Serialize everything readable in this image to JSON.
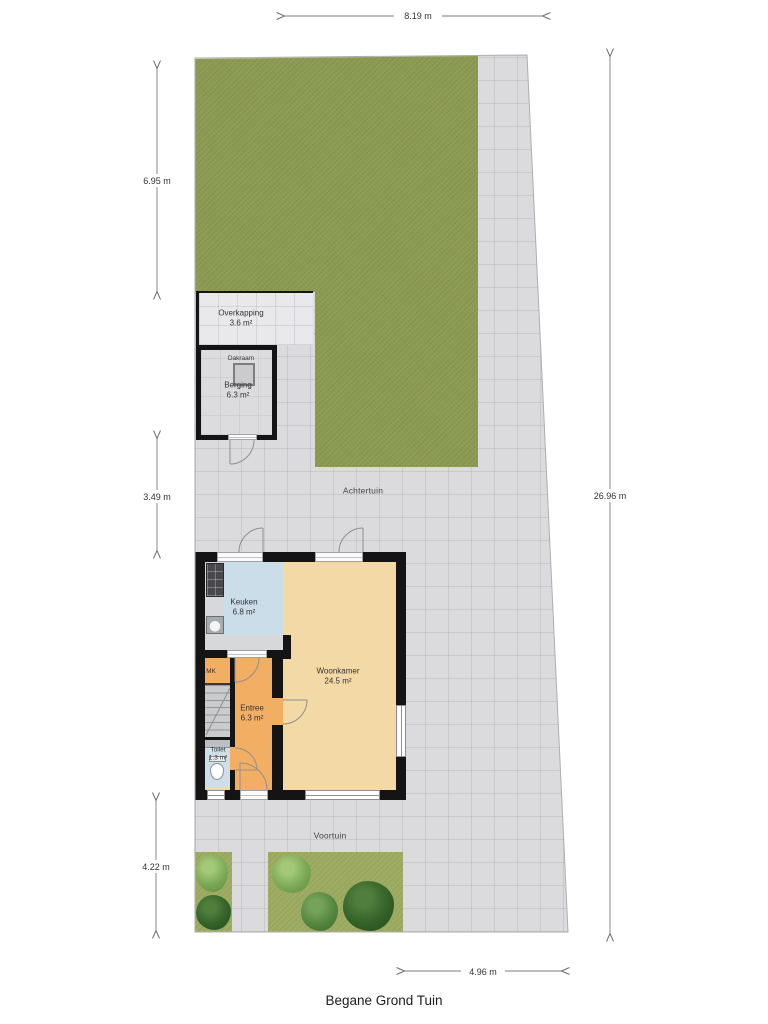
{
  "title": "Begane Grond Tuin",
  "dimensions": {
    "top": "8.19 m",
    "left_upper": "6.95 m",
    "left_middle": "3.49 m",
    "left_lower": "4.22 m",
    "right": "26.96 m",
    "bottom": "4.96 m"
  },
  "garden": {
    "back_label": "Achtertuin",
    "front_label": "Voortuin"
  },
  "rooms": {
    "overkapping": {
      "name": "Overkapping",
      "area": "3.6 m²"
    },
    "berging": {
      "name": "Berging",
      "area": "6.3 m²"
    },
    "dakraam": {
      "name": "Dakraam"
    },
    "keuken": {
      "name": "Keuken",
      "area": "6.8 m²"
    },
    "woonkamer": {
      "name": "Woonkamer",
      "area": "24.5 m²"
    },
    "entree": {
      "name": "Entree",
      "area": "6.3 m²"
    },
    "toilet": {
      "name": "Toilet",
      "area": "1.3 m²"
    },
    "meterkast": {
      "name": "MK"
    }
  },
  "colors": {
    "lawn-back": "#8b9a50",
    "lawn-front": "#9dab60",
    "paving": "#dbdbdd",
    "paving-light": "#e9e9eb",
    "wall": "#141414",
    "floor-living": "#f3d9a6",
    "floor-hall": "#f2af63",
    "floor-kitchen": "#cbdde9",
    "floor-toilet": "#cedfe9",
    "bush-light": "#7ca955",
    "bush-mid": "#558740",
    "bush-dark": "#346228"
  }
}
